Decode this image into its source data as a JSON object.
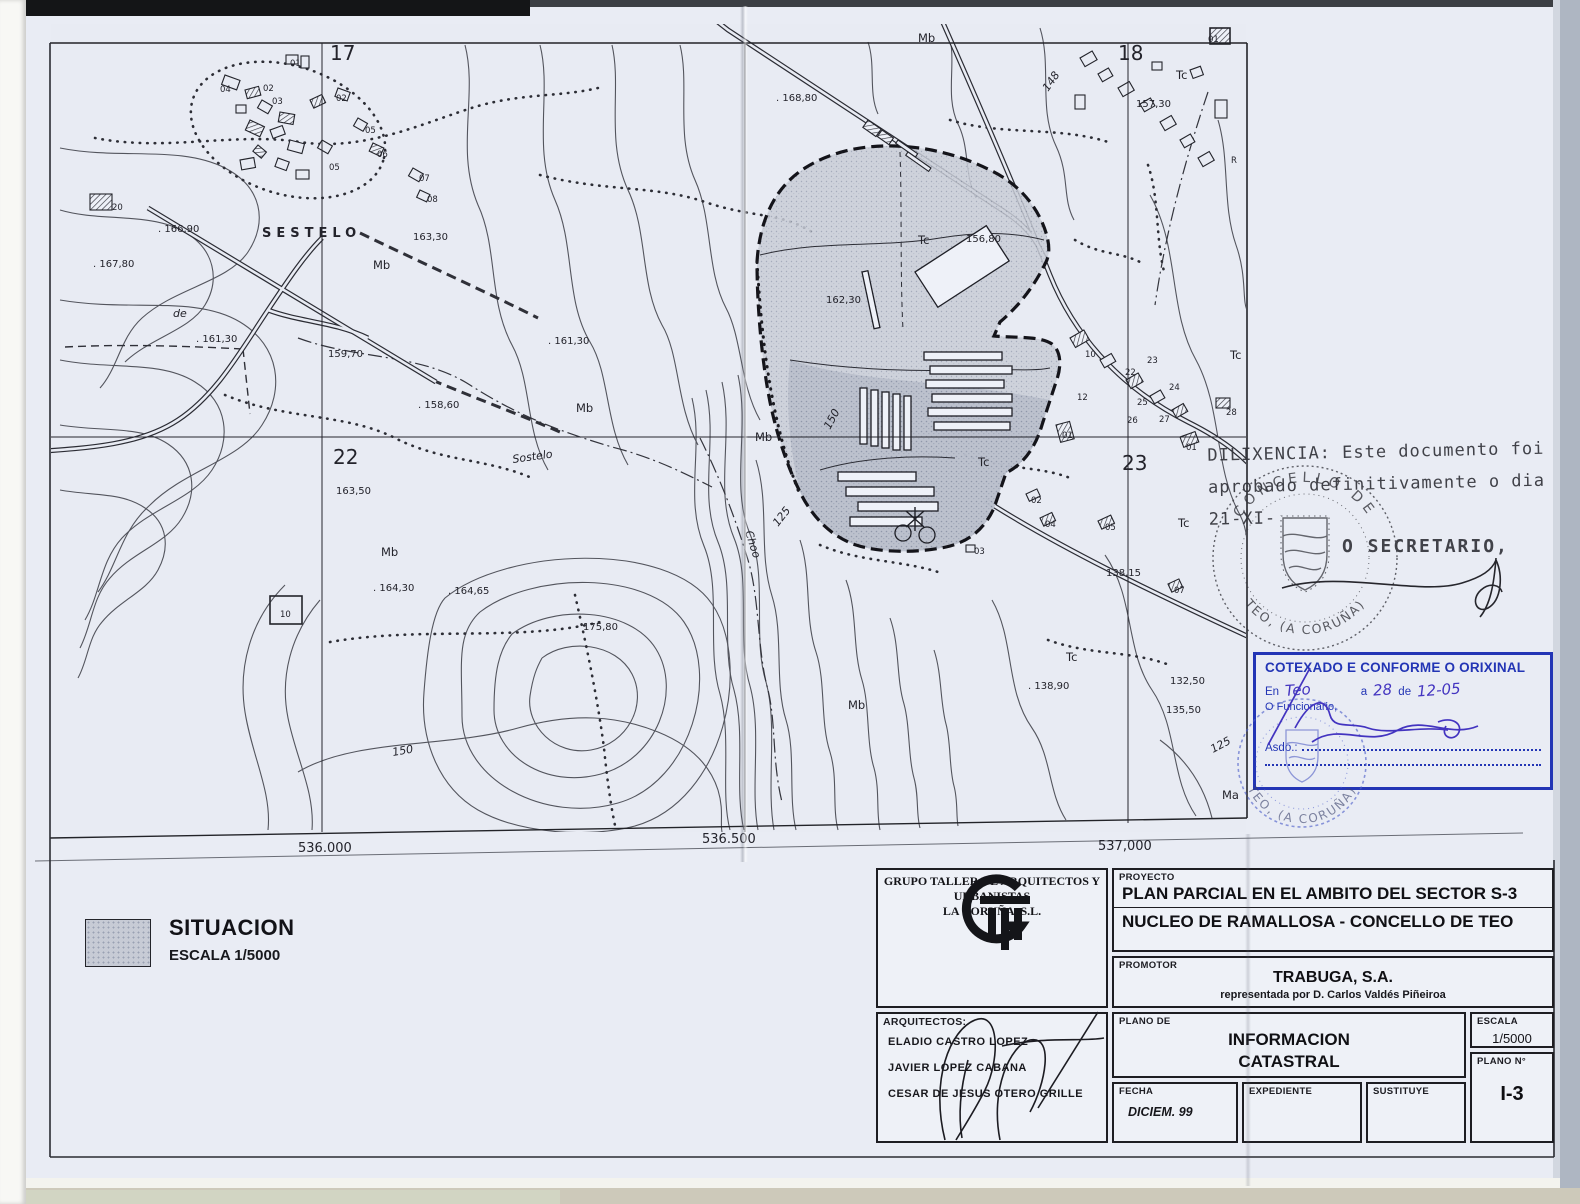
{
  "colors": {
    "stamp_blue": "#2335b5",
    "ink": "#23232b",
    "sector_gray": "#c9cdd7"
  },
  "legend": {
    "title": "SITUACION",
    "scale": "ESCALA 1/5000"
  },
  "stamps": {
    "dilixencia_line1": "DILIXENCIA: Este documento foi",
    "dilixencia_line2": "aprobado definitivamente o dia",
    "dilixencia_line3": "21-XI-",
    "secretario": "O SECRETARIO,",
    "round_top": "CONCELLO DE",
    "round_bottom": "TEO, (A CORUÑA)",
    "blue_round_bottom": "TEO, (A CORUÑA)",
    "cotexado_title": "COTEXADO E CONFORME O ORIXINAL",
    "cotexado_en": "En",
    "cotexado_place": "Teo",
    "cotexado_a": "a",
    "cotexado_day": "28",
    "cotexado_de": "de",
    "cotexado_month": "12-05",
    "cotexado_funcionario": "O Funcionario,",
    "cotexado_asdo": "Asdo.:"
  },
  "title_block": {
    "org_line1": "GRUPO TALLER DE ARQUITECTOS Y URBANISTAS",
    "org_line2": "LA CORUÑA, S.L.",
    "proyecto_label": "PROYECTO",
    "proyecto_line1": "PLAN PARCIAL EN EL AMBITO DEL SECTOR S-3",
    "proyecto_line2": "NUCLEO DE RAMALLOSA - CONCELLO DE TEO",
    "promotor_label": "PROMOTOR",
    "promotor_name": "TRABUGA, S.A.",
    "promotor_rep": "representada por D. Carlos Valdés Piñeiroa",
    "planode_label": "PLANO DE",
    "planode_line1": "INFORMACION",
    "planode_line2": "CATASTRAL",
    "escala_label": "ESCALA",
    "escala_value": "1/5000",
    "planon_label": "PLANO N°",
    "planon_value": "I-3",
    "fecha_label": "FECHA",
    "fecha_value": "DICIEM. 99",
    "expediente_label": "EXPEDIENTE",
    "sustituye_label": "SUSTITUYE",
    "arquitectos_label": "ARQUITECTOS:",
    "arq1": "ELADIO CASTRO LOPEZ",
    "arq2": "JAVIER LOPEZ CABANA",
    "arq3": "CESAR DE JESUS OTERO GRILLE"
  },
  "map": {
    "labels": [
      {
        "t": "17",
        "x": 330,
        "y": 60,
        "c": "grid"
      },
      {
        "t": "18",
        "x": 1118,
        "y": 60,
        "c": "grid"
      },
      {
        "t": "22",
        "x": 333,
        "y": 464,
        "c": "grid"
      },
      {
        "t": "23",
        "x": 1122,
        "y": 470,
        "c": "grid"
      },
      {
        "t": "536.000",
        "x": 298,
        "y": 852,
        "c": "coord"
      },
      {
        "t": "536.500",
        "x": 702,
        "y": 843,
        "c": "coord"
      },
      {
        "t": "537,000",
        "x": 1098,
        "y": 850,
        "c": "coord"
      },
      {
        "t": ". 166,90",
        "x": 158,
        "y": 232,
        "c": "el"
      },
      {
        "t": ". 167,80",
        "x": 93,
        "y": 267,
        "c": "el"
      },
      {
        "t": "163,30",
        "x": 413,
        "y": 240,
        "c": "el"
      },
      {
        "t": ". 161,30",
        "x": 196,
        "y": 342,
        "c": "el"
      },
      {
        "t": "159,70",
        "x": 328,
        "y": 357,
        "c": "el"
      },
      {
        "t": ". 158,60",
        "x": 418,
        "y": 408,
        "c": "el"
      },
      {
        "t": ". 161,30",
        "x": 548,
        "y": 344,
        "c": "el"
      },
      {
        "t": "163,50",
        "x": 336,
        "y": 494,
        "c": "el"
      },
      {
        "t": ". 164,30",
        "x": 373,
        "y": 591,
        "c": "el"
      },
      {
        "t": ". 164,65",
        "x": 448,
        "y": 594,
        "c": "el"
      },
      {
        "t": "175,80",
        "x": 583,
        "y": 630,
        "c": "el"
      },
      {
        "t": "162,30",
        "x": 826,
        "y": 303,
        "c": "el"
      },
      {
        "t": "156,80",
        "x": 966,
        "y": 242,
        "c": "el"
      },
      {
        "t": "157,30",
        "x": 1136,
        "y": 107,
        "c": "el"
      },
      {
        "t": "138,15",
        "x": 1106,
        "y": 576,
        "c": "el"
      },
      {
        "t": ". 138,90",
        "x": 1028,
        "y": 689,
        "c": "el"
      },
      {
        "t": "132,50",
        "x": 1170,
        "y": 684,
        "c": "el"
      },
      {
        "t": "135,50",
        "x": 1166,
        "y": 713,
        "c": "el"
      },
      {
        "t": ". 168,80",
        "x": 776,
        "y": 101,
        "c": "el"
      },
      {
        "t": "Mb",
        "x": 918,
        "y": 42,
        "c": "ter"
      },
      {
        "t": "Mb",
        "x": 373,
        "y": 269,
        "c": "ter"
      },
      {
        "t": "Mb",
        "x": 576,
        "y": 412,
        "c": "ter"
      },
      {
        "t": "Mb",
        "x": 755,
        "y": 441,
        "c": "ter"
      },
      {
        "t": "Mb",
        "x": 381,
        "y": 556,
        "c": "ter"
      },
      {
        "t": "Mb",
        "x": 848,
        "y": 709,
        "c": "ter"
      },
      {
        "t": "Ma",
        "x": 1222,
        "y": 799,
        "c": "ter"
      },
      {
        "t": "Tc",
        "x": 918,
        "y": 244,
        "c": "ter"
      },
      {
        "t": "Tc",
        "x": 978,
        "y": 466,
        "c": "ter"
      },
      {
        "t": "Tc",
        "x": 1178,
        "y": 527,
        "c": "ter"
      },
      {
        "t": "Tc",
        "x": 1230,
        "y": 359,
        "c": "ter"
      },
      {
        "t": "Tc",
        "x": 1066,
        "y": 661,
        "c": "ter"
      },
      {
        "t": "Tc",
        "x": 1176,
        "y": 79,
        "c": "ter"
      },
      {
        "t": "SESTELO",
        "x": 262,
        "y": 237,
        "c": "name"
      },
      {
        "t": "Sostelo",
        "x": 513,
        "y": 463,
        "c": "stream",
        "r": -8
      },
      {
        "t": "Choo",
        "x": 745,
        "y": 532,
        "c": "stream",
        "r": 72
      },
      {
        "t": "de",
        "x": 173,
        "y": 317,
        "c": "stream"
      },
      {
        "t": "150",
        "x": 393,
        "y": 756,
        "c": "cont",
        "r": -10
      },
      {
        "t": "125",
        "x": 778,
        "y": 527,
        "c": "cont",
        "r": -52
      },
      {
        "t": "125",
        "x": 1213,
        "y": 753,
        "c": "cont",
        "r": -28
      },
      {
        "t": "150",
        "x": 830,
        "y": 430,
        "c": "cont",
        "r": -62
      },
      {
        "t": "148",
        "x": 1048,
        "y": 92,
        "c": "cont",
        "r": -55
      },
      {
        "t": "01",
        "x": 290,
        "y": 66,
        "c": "num"
      },
      {
        "t": "02",
        "x": 336,
        "y": 101,
        "c": "num"
      },
      {
        "t": "03",
        "x": 272,
        "y": 104,
        "c": "num"
      },
      {
        "t": "04",
        "x": 220,
        "y": 92,
        "c": "num"
      },
      {
        "t": "05",
        "x": 329,
        "y": 170,
        "c": "num"
      },
      {
        "t": "06",
        "x": 377,
        "y": 157,
        "c": "num"
      },
      {
        "t": "07",
        "x": 419,
        "y": 181,
        "c": "num"
      },
      {
        "t": "08",
        "x": 427,
        "y": 202,
        "c": "num"
      },
      {
        "t": "05",
        "x": 365,
        "y": 133,
        "c": "num"
      },
      {
        "t": "02",
        "x": 263,
        "y": 91,
        "c": "num"
      },
      {
        "t": "20",
        "x": 112,
        "y": 210,
        "c": "num"
      },
      {
        "t": "10",
        "x": 280,
        "y": 617,
        "c": "num"
      },
      {
        "t": "01",
        "x": 1208,
        "y": 42,
        "c": "num"
      },
      {
        "t": "R",
        "x": 1231,
        "y": 163,
        "c": "num"
      },
      {
        "t": "10",
        "x": 1085,
        "y": 357,
        "c": "num"
      },
      {
        "t": "23",
        "x": 1147,
        "y": 363,
        "c": "num"
      },
      {
        "t": "22",
        "x": 1125,
        "y": 375,
        "c": "num"
      },
      {
        "t": "24",
        "x": 1169,
        "y": 390,
        "c": "num"
      },
      {
        "t": "12",
        "x": 1077,
        "y": 400,
        "c": "num"
      },
      {
        "t": "25",
        "x": 1137,
        "y": 405,
        "c": "num"
      },
      {
        "t": "26",
        "x": 1127,
        "y": 423,
        "c": "num"
      },
      {
        "t": "27",
        "x": 1159,
        "y": 422,
        "c": "num"
      },
      {
        "t": "28",
        "x": 1226,
        "y": 415,
        "c": "num"
      },
      {
        "t": "01",
        "x": 1062,
        "y": 438,
        "c": "num"
      },
      {
        "t": "01",
        "x": 1186,
        "y": 450,
        "c": "num"
      },
      {
        "t": "02",
        "x": 1031,
        "y": 503,
        "c": "num"
      },
      {
        "t": "04",
        "x": 1045,
        "y": 527,
        "c": "num"
      },
      {
        "t": "05",
        "x": 1105,
        "y": 530,
        "c": "num"
      },
      {
        "t": "03",
        "x": 974,
        "y": 554,
        "c": "num"
      },
      {
        "t": "07",
        "x": 1174,
        "y": 593,
        "c": "num"
      }
    ]
  }
}
